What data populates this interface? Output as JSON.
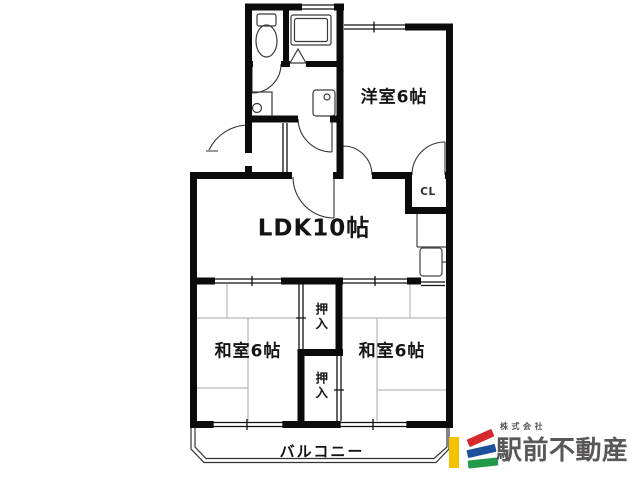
{
  "floorplan": {
    "labels": {
      "western_room": "洋室6帖",
      "ldk": "LDK10帖",
      "japanese_room_left": "和室6帖",
      "japanese_room_right": "和室6帖",
      "closet_upper": "押入",
      "closet_lower": "押入",
      "closet_cl": "CL",
      "balcony": "バルコニー"
    }
  },
  "branding": {
    "company_prefix": "株式会社",
    "company_name": "駅前不動産",
    "colors": {
      "yellow": "#f3c301",
      "red": "#d7282d",
      "blue": "#1d4f9c",
      "green": "#23994a",
      "text_gray": "#595757"
    }
  }
}
